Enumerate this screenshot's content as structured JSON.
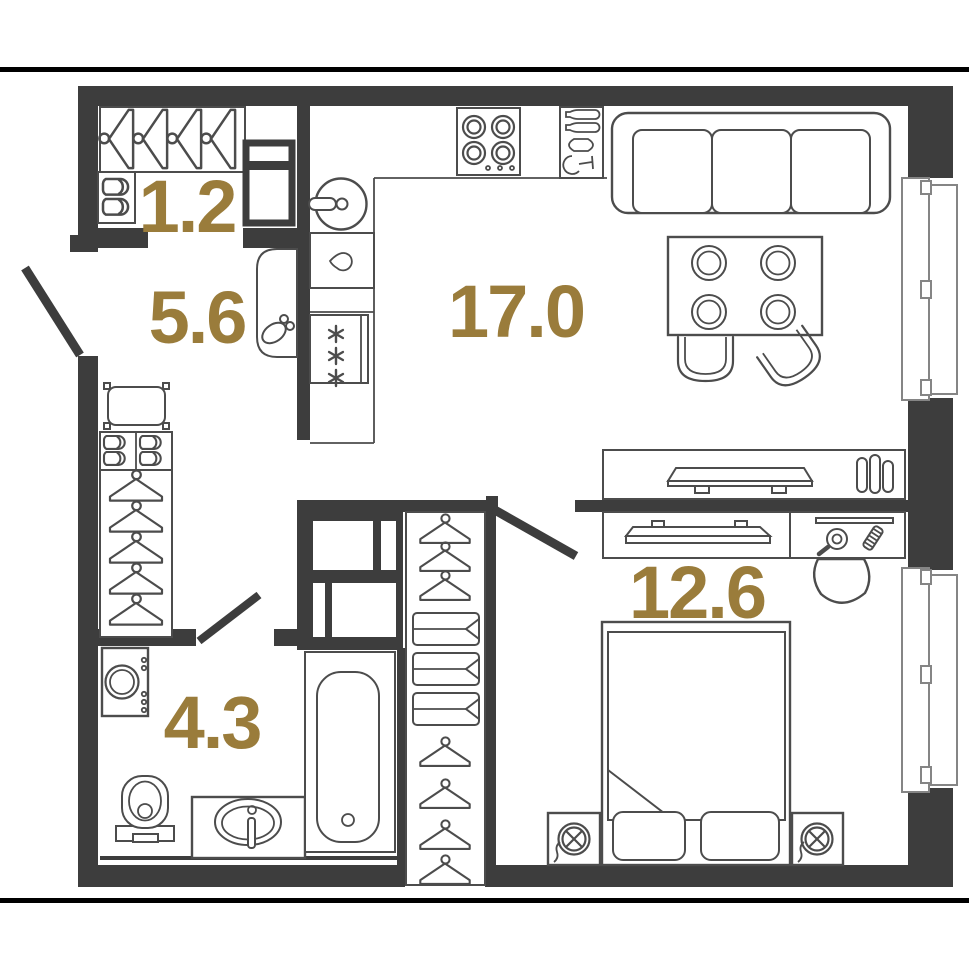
{
  "title": "Studio apartment floor plan",
  "colors": {
    "wall": "#3d3d3d",
    "line": "#4c4c4c",
    "area_label": "#9a7c3b",
    "background": "#ffffff",
    "boundary": "#000000"
  },
  "rooms": [
    {
      "name": "entry-closet",
      "area_label": "1.2"
    },
    {
      "name": "hallway",
      "area_label": "5.6"
    },
    {
      "name": "kitchen-living-room",
      "area_label": "17.0"
    },
    {
      "name": "bathroom",
      "area_label": "4.3"
    },
    {
      "name": "bedroom",
      "area_label": "12.6"
    }
  ],
  "furniture_icons": {
    "entry_closet": [
      "hanger-rod-icon",
      "shoe-shelf-icon",
      "tall-cabinet-icon"
    ],
    "hallway": [
      "entry-door-icon",
      "pouf-icon",
      "shoe-cabinet-icon",
      "wardrobe-hangers-icon",
      "sliding-door-icon"
    ],
    "kitchen_living_room": [
      "kitchen-sink-icon",
      "dishwasher-icon",
      "refrigerator-icon",
      "stove-icon",
      "bottle-rack-icon",
      "sofa-icon",
      "dining-table-icon",
      "chair-icon",
      "tv-console-icon",
      "tv-icon",
      "radiator-icon",
      "window-icon"
    ],
    "bathroom": [
      "washing-machine-icon",
      "toilet-icon",
      "sink-vanity-icon",
      "bathtub-icon",
      "door-icon",
      "ventilation-shaft-icon"
    ],
    "bedroom": [
      "door-icon",
      "wardrobe-column-icon",
      "drawer-icon",
      "bed-icon",
      "pillow-icon",
      "nightstand-icon",
      "lamp-icon",
      "dresser-icon",
      "tv-icon",
      "vanity-shelf-icon",
      "hand-mirror-icon",
      "comb-icon",
      "chair-icon",
      "window-icon"
    ]
  }
}
